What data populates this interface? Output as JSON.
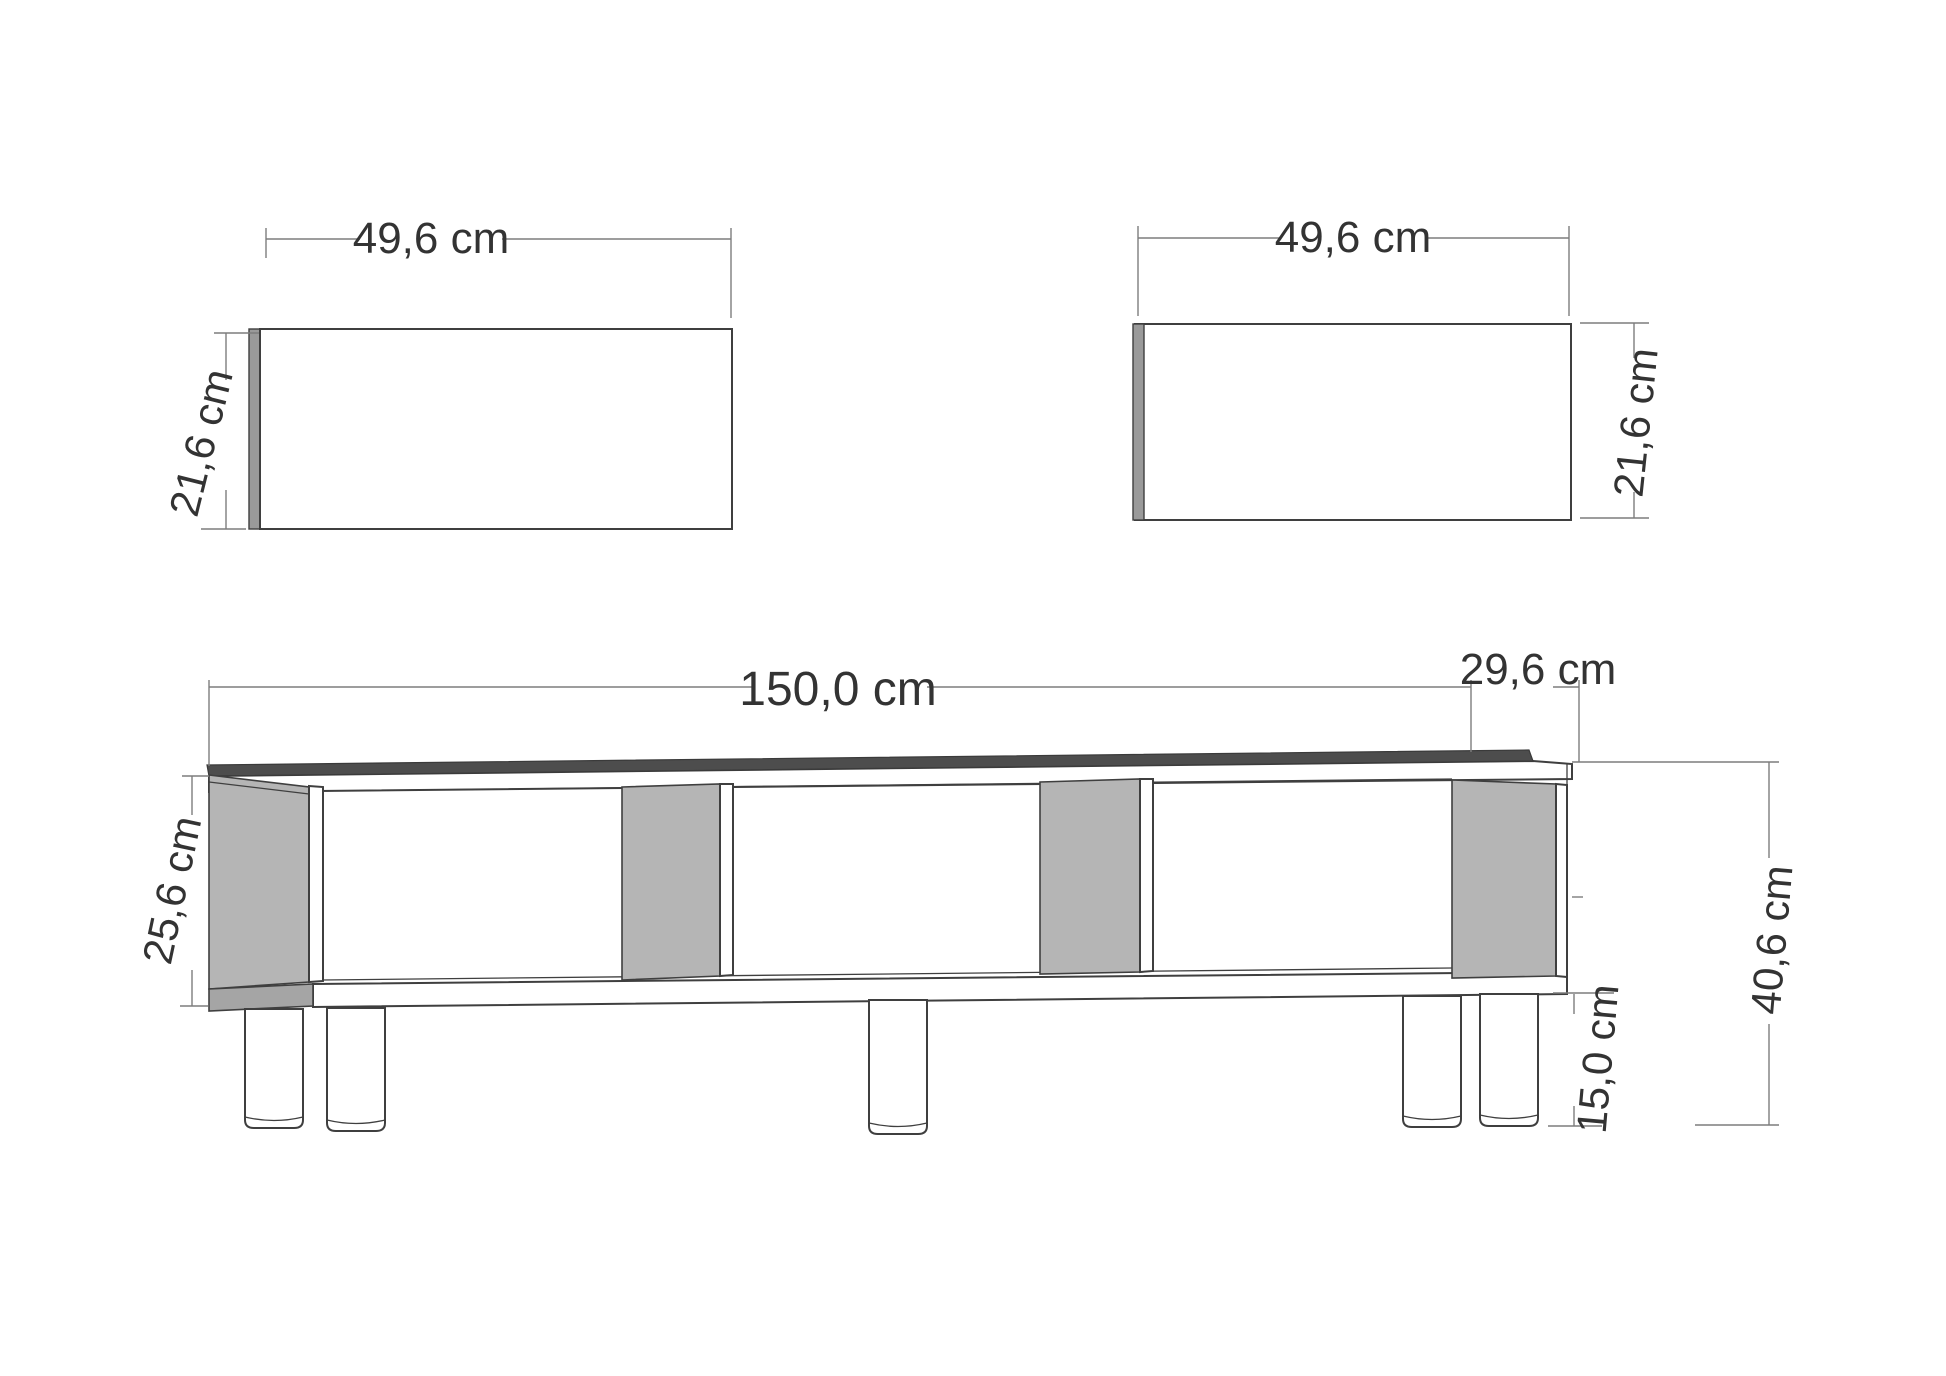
{
  "document": {
    "type": "furniture-dimension-drawing",
    "subject": "TV stand with two shelf panels, front perspective views with dimensions"
  },
  "colors": {
    "background": "#ffffff",
    "line": "#3f3f3f",
    "dim_line": "#7d7d7d",
    "text": "#333333",
    "panel_gray": "#b5b5b5",
    "panel_gray_dark": "#a5a5a5",
    "edge_strip_gray": "#9a9a9a",
    "top_surface_gray": "#4d4d4d"
  },
  "views": {
    "left_panel": {
      "width_label": "49,6 cm",
      "height_label": "21,6 cm"
    },
    "right_panel": {
      "width_label": "49,6 cm",
      "height_label": "21,6 cm"
    },
    "stand": {
      "width_label": "150,0 cm",
      "depth_label": "29,6 cm",
      "body_height_label": "25,6 cm",
      "leg_height_label": "15,0 cm",
      "overall_height_label": "40,6 cm"
    }
  },
  "dimensions_cm": {
    "shelf_panel_width": "49,6",
    "shelf_panel_height": "21,6",
    "stand_width": "150,0",
    "stand_depth": "29,6",
    "carcass_height": "25,6",
    "leg_height": "15,0",
    "overall_height": "40,6"
  }
}
